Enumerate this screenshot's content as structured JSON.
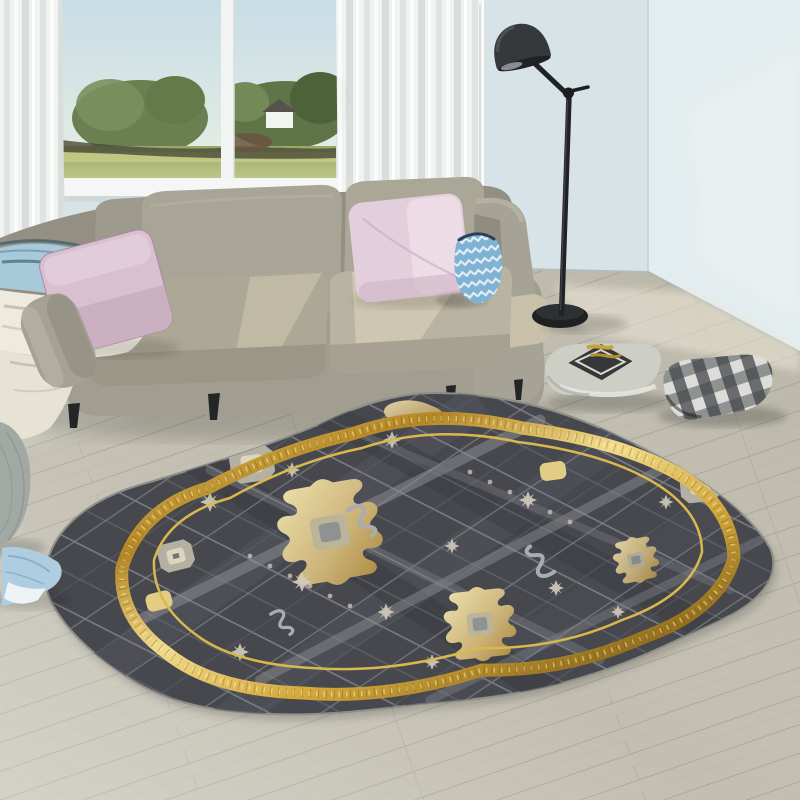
{
  "scene": {
    "description": "Bright living-room product photograph: an ornate dark-gray and gold scallop-edged area rug on a diagonal light wood floor in front of a gray fabric sofa with pink and blue pillows, sheer curtains, a window with a countryside view, a black dome floor lamp, two floor cushions, a knit pouf and a light-blue cloth",
    "text_content": "none"
  },
  "room": {
    "back_wall_color": "#d8e3e7",
    "right_wall_color": "#e3ecee",
    "corner_line_color": "#c3ced2",
    "floor_color": "#c2beb0",
    "floor_plank_line": "#a39f92",
    "floor_material": "light gray-beige wood planks laid diagonally"
  },
  "window": {
    "frame_color": "#f4f6f5",
    "sill_color": "#f5f7f6",
    "view": {
      "sky_top": "#c9dde6",
      "sky_bottom": "#edf1e3",
      "tree_green": "#637a4b",
      "tree_dark": "#4e6239",
      "grass": "#9aa964",
      "grass_light": "#c6cc86",
      "shrub_dark": "#4a4a38",
      "bush_red": "#6b5340",
      "house_wall": "#f2f4f0",
      "house_roof": "#56524d"
    }
  },
  "curtains": {
    "color": "#f1f3f1",
    "style": "sheer white, left of window and right of window"
  },
  "sofa": {
    "fabric_color": "#a19d90",
    "back_panel_color": "#938f83",
    "cushion_color": "#a8a496",
    "seat_color": "#aca896",
    "seat_sunlit": "#d8cfb8",
    "front_color": "#9b9786",
    "arm_color": "#a6a295",
    "beige_cushion": "#c9c0a9",
    "leg_color": "#232526"
  },
  "pillows": {
    "pink_left": "#d9bfcf",
    "pink_left_shade": "#c5aaba",
    "pink_right": "#e3cedb",
    "pink_right_lit": "#eedde8",
    "blue_chevron": "#7fb2d3",
    "chevron_line": "#eef6fa",
    "gray_bolster": "#a6a195"
  },
  "throws": {
    "blue_blanket": "#a7c9da",
    "blue_stripe": "#547485",
    "white_throw": "#eeeade",
    "throw_stripe": "#bcb8ac"
  },
  "floor_lamp": {
    "metal_color": "#202224",
    "shade_color": "#35393c",
    "shade_shape": "dome tilted over sofa",
    "inner_lip": "#9aa0a2"
  },
  "floor_cushions": {
    "geometric": {
      "base": "#cdcec6",
      "print_dark": "#2c2f32",
      "print_gold": "#c9a23e",
      "front": "#c3c4bc"
    },
    "plaid": {
      "base": "#dcdcd8",
      "check_dark": "#44474a"
    }
  },
  "pouf_color": "#a2a8a4",
  "blue_cloth": {
    "color": "#aecde0",
    "fold": "#7fa8c0",
    "underside": "#eef3f6"
  },
  "rug": {
    "shape": "scalloped quatrefoil oval with gold glitter border",
    "field_color": "#46484e",
    "band_gold_mid": "#d4a93c",
    "band_gold_light": "#f2dc8c",
    "band_gold_dark": "#8f6b1c",
    "inner_line_gold": "#d9b84f",
    "lattice_light": "#85888d",
    "band_light_gray": "#8f9297",
    "motif_cream": "#d3cdbb",
    "motif_light": "#b5b1a2",
    "motif_gold": "#cbb277",
    "pattern": "tribal kilim: hooked gold medallions, diamond lattice bands, cream stars, octagon guls, dot rows"
  }
}
